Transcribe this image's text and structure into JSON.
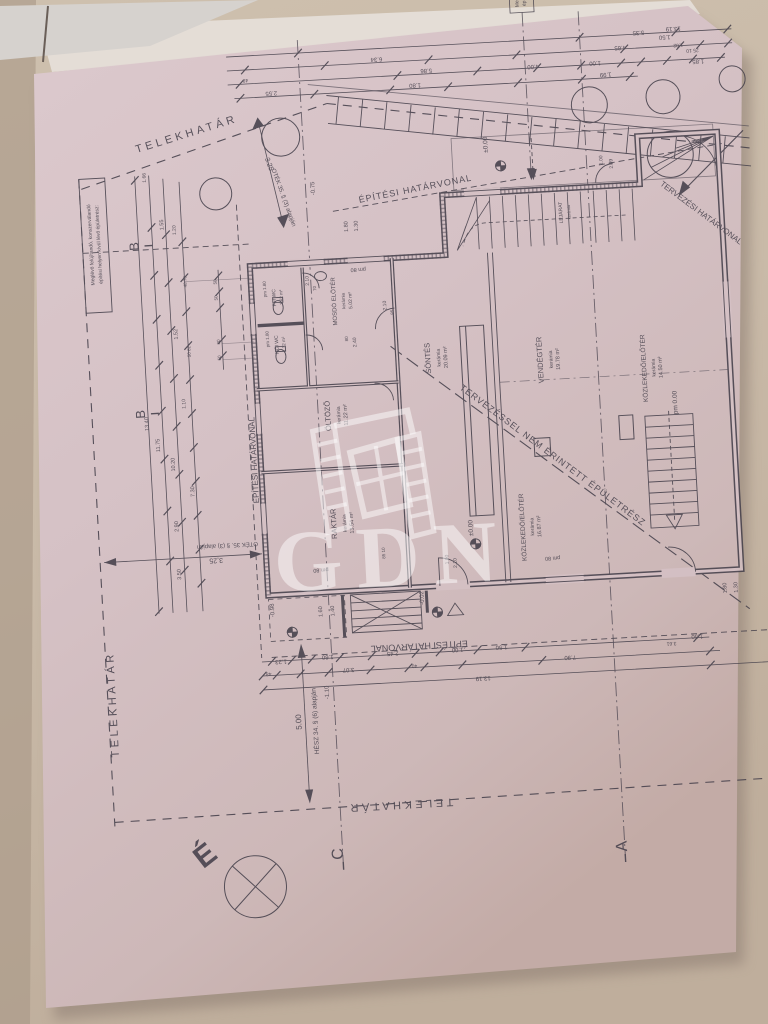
{
  "photo": {
    "background_wall": "#c9baa8",
    "paper_color": "#d6c2c6",
    "ink_color": "#45404b",
    "watermark_color": "rgba(255,255,255,0.5)"
  },
  "watermark": {
    "text": "GDN"
  },
  "compass": {
    "north_letter": "É"
  },
  "plan": {
    "labels": [
      {
        "t": "TELEKHATÁR",
        "x": 207,
        "y": 126,
        "r": -14,
        "s": 11,
        "ls": 3.5
      },
      {
        "t": "TELEKHATÁR",
        "x": 104,
        "y": 688,
        "r": -90,
        "s": 11,
        "ls": 3.5
      },
      {
        "t": "TELEKHATÁR",
        "x": 382,
        "y": 801,
        "r": 180,
        "s": 11,
        "ls": 3.5
      },
      {
        "t": "ÉPÍTÉSI HATÁRVONAL",
        "x": 432,
        "y": 193,
        "r": -8,
        "s": 9,
        "ls": 1
      },
      {
        "t": "ÉPÍTÉSI HATÁRVONAL",
        "x": 258,
        "y": 452,
        "r": -90,
        "s": 8
      },
      {
        "t": "ÉPÍTÉSI HATÁRVONAL",
        "x": 410,
        "y": 644,
        "r": 180,
        "s": 9
      },
      {
        "t": "TERVEZÉSI HATÁRVONAL",
        "x": 714,
        "y": 232,
        "r": 40,
        "s": 8
      },
      {
        "t": "TERVEZÉSSEL NEM ÉRINTETT ÉPÜLETRÉSZ",
        "x": 552,
        "y": 466,
        "r": 40,
        "s": 9,
        "ls": 1
      },
      {
        "t": "OTÉK 35. § (3) alapján",
        "x": 298,
        "y": 192,
        "r": 73,
        "s": 6
      },
      {
        "t": "3.25",
        "x": 285,
        "y": 158,
        "r": 73,
        "s": 7
      },
      {
        "t": "OTÉK 35. § (3) alapján",
        "x": 224,
        "y": 534,
        "r": 180,
        "s": 6
      },
      {
        "t": "3,25",
        "x": 212,
        "y": 548,
        "r": 180,
        "s": 7
      },
      {
        "t": "HÉSZ 34. § (6) alapján",
        "x": 304,
        "y": 716,
        "r": -90,
        "s": 6.5
      },
      {
        "t": "5.00",
        "x": 288,
        "y": 716,
        "r": -90,
        "s": 8
      },
      {
        "t": "Meglévő felújítandó, konszerválandó",
        "x": 106,
        "y": 228,
        "r": -90,
        "s": 5
      },
      {
        "t": "építési helyen kívül lévő épületrész:",
        "x": 114,
        "y": 228,
        "r": -90,
        "s": 5
      },
      {
        "t": "Me",
        "x": 545,
        "y": 11,
        "r": -90,
        "s": 5
      },
      {
        "t": "ép",
        "x": 552,
        "y": 11,
        "r": -90,
        "s": 5
      },
      {
        "t": "É",
        "x": 190,
        "y": 852,
        "r": -35,
        "s": 30,
        "w": 1
      },
      {
        "t": "C",
        "x": 322,
        "y": 850,
        "r": -90,
        "s": 16
      },
      {
        "t": "A",
        "x": 606,
        "y": 858,
        "r": -90,
        "s": 16
      },
      {
        "t": "B",
        "x": 152,
        "y": 232,
        "r": -90,
        "s": 13
      },
      {
        "t": "B",
        "x": 149,
        "y": 400,
        "r": -90,
        "s": 13
      },
      {
        "t": "SÖNTÉS",
        "x": 437,
        "y": 360,
        "r": -90,
        "s": 7.5
      },
      {
        "t": "kerámia",
        "x": 447,
        "y": 360,
        "r": -90,
        "s": 5
      },
      {
        "t": "20.09 m²",
        "x": 454,
        "y": 360,
        "r": -90,
        "s": 5.5
      },
      {
        "t": "VENDÉGTÉR",
        "x": 549,
        "y": 368,
        "r": -90,
        "s": 7.5
      },
      {
        "t": "kerámia",
        "x": 559,
        "y": 368,
        "r": -90,
        "s": 5
      },
      {
        "t": "19.78 m²",
        "x": 566,
        "y": 368,
        "r": -90,
        "s": 5.5
      },
      {
        "t": "KÖZLEKEDŐ/ELŐTÉR",
        "x": 652,
        "y": 382,
        "r": -90,
        "s": 6.5
      },
      {
        "t": "kerámia",
        "x": 661,
        "y": 382,
        "r": -90,
        "s": 5
      },
      {
        "t": "14.50 m²",
        "x": 668,
        "y": 382,
        "r": -90,
        "s": 5.5
      },
      {
        "t": "KÖZLEKEDŐ/ELŐTÉR",
        "x": 522,
        "y": 534,
        "r": -90,
        "s": 6.5
      },
      {
        "t": "kerámia",
        "x": 531,
        "y": 534,
        "r": -90,
        "s": 5
      },
      {
        "t": "16.87 m²",
        "x": 538,
        "y": 534,
        "r": -90,
        "s": 5.5
      },
      {
        "t": "ÖLTÖZŐ",
        "x": 334,
        "y": 412,
        "r": -90,
        "s": 7.5
      },
      {
        "t": "kerámia",
        "x": 344,
        "y": 412,
        "r": -90,
        "s": 5
      },
      {
        "t": "11.22 m²",
        "x": 351,
        "y": 412,
        "r": -90,
        "s": 5.5
      },
      {
        "t": "RAKTÁR",
        "x": 334,
        "y": 520,
        "r": -90,
        "s": 7.5
      },
      {
        "t": "kerámia",
        "x": 344,
        "y": 520,
        "r": -90,
        "s": 5
      },
      {
        "t": "13.54 m²",
        "x": 351,
        "y": 520,
        "r": -90,
        "s": 5.5
      },
      {
        "t": "MOSDÓ ELŐTÉR",
        "x": 346,
        "y": 298,
        "r": -90,
        "s": 6
      },
      {
        "t": "kerámia",
        "x": 355,
        "y": 298,
        "r": -90,
        "s": 4.5
      },
      {
        "t": "5.02 m²",
        "x": 362,
        "y": 298,
        "r": -90,
        "s": 5
      },
      {
        "t": "FFI WC",
        "x": 286,
        "y": 291,
        "r": -90,
        "s": 5
      },
      {
        "t": "1.62 m²",
        "x": 293,
        "y": 291,
        "r": -90,
        "s": 4.5
      },
      {
        "t": "pm 1.80",
        "x": 277,
        "y": 282,
        "r": -90,
        "s": 4.5
      },
      {
        "t": "NŐI WC",
        "x": 286,
        "y": 338,
        "r": -90,
        "s": 5
      },
      {
        "t": "1.32 m²",
        "x": 293,
        "y": 338,
        "r": -90,
        "s": 4.5
      },
      {
        "t": "pm 1.80",
        "x": 277,
        "y": 332,
        "r": -90,
        "s": 4.5
      },
      {
        "t": "LEJÁRAT",
        "x": 577,
        "y": 222,
        "r": -90,
        "s": 5
      },
      {
        "t": "kerámia",
        "x": 585,
        "y": 222,
        "r": -90,
        "s": 4
      },
      {
        "t": "±0.00",
        "x": 470,
        "y": 532,
        "r": -90,
        "s": 6.5
      },
      {
        "t": "±0.00",
        "x": 506,
        "y": 150,
        "r": -90,
        "s": 6.5
      },
      {
        "t": "pm 0.00",
        "x": 681,
        "y": 418,
        "r": -90,
        "s": 6.5
      },
      {
        "t": "-0.75",
        "x": 331,
        "y": 184,
        "r": -90,
        "s": 6
      },
      {
        "t": "-0.98",
        "x": 267,
        "y": 603,
        "r": -90,
        "s": 6
      },
      {
        "t": "-0.02",
        "x": 417,
        "y": 599,
        "r": -90,
        "s": 6
      },
      {
        "t": "-1.10",
        "x": 317,
        "y": 688,
        "r": -90,
        "s": 6
      },
      {
        "t": "pm 80",
        "x": 370,
        "y": 266,
        "r": 180,
        "s": 5.5
      },
      {
        "t": "pm 80",
        "x": 548,
        "y": 565,
        "r": 180,
        "s": 5.5
      },
      {
        "t": "pm 80",
        "x": 316,
        "y": 564,
        "r": 180,
        "s": 5.5
      },
      {
        "t": "13.19",
        "x": 698,
        "y": 43,
        "r": 180,
        "s": 6
      },
      {
        "t": "6.34",
        "x": 400,
        "y": 57,
        "r": 180,
        "s": 6
      },
      {
        "t": "5.86",
        "x": 449,
        "y": 71,
        "r": 180,
        "s": 6
      },
      {
        "t": "2.55",
        "x": 293,
        "y": 85,
        "r": 180,
        "s": 6
      },
      {
        "t": "1.80",
        "x": 437,
        "y": 85,
        "r": 180,
        "s": 6
      },
      {
        "t": "1.99",
        "x": 628,
        "y": 85,
        "r": 180,
        "s": 6
      },
      {
        "t": "48",
        "x": 268,
        "y": 71,
        "r": 180,
        "s": 5
      },
      {
        "t": "5.35",
        "x": 663,
        "y": 45,
        "r": 180,
        "s": 6
      },
      {
        "t": "4.65",
        "x": 644,
        "y": 59,
        "r": 180,
        "s": 6
      },
      {
        "t": "4.00",
        "x": 556,
        "y": 73,
        "r": 180,
        "s": 6
      },
      {
        "t": "1.00",
        "x": 618,
        "y": 73,
        "r": 180,
        "s": 6
      },
      {
        "t": "1.50",
        "x": 689,
        "y": 51,
        "r": 180,
        "s": 6
      },
      {
        "t": "1.85",
        "x": 721,
        "y": 77,
        "r": 180,
        "s": 6
      },
      {
        "t": "1.02",
        "x": 702,
        "y": 60,
        "r": 180,
        "s": 5
      },
      {
        "t": "25 10",
        "x": 716,
        "y": 66,
        "r": 180,
        "s": 5
      },
      {
        "t": "13.40",
        "x": 152,
        "y": 410,
        "r": -90,
        "s": 5.5
      },
      {
        "t": "11.75",
        "x": 162,
        "y": 432,
        "r": -90,
        "s": 5.5
      },
      {
        "t": "10.20",
        "x": 176,
        "y": 452,
        "r": -90,
        "s": 5.5
      },
      {
        "t": "2.90",
        "x": 176,
        "y": 514,
        "r": -90,
        "s": 5.5
      },
      {
        "t": "7.30",
        "x": 194,
        "y": 480,
        "r": -90,
        "s": 5.5
      },
      {
        "t": "3.50",
        "x": 176,
        "y": 562,
        "r": -90,
        "s": 5.5
      },
      {
        "t": "1.55",
        "x": 178,
        "y": 212,
        "r": -90,
        "s": 5.5
      },
      {
        "t": "1.20",
        "x": 190,
        "y": 218,
        "r": -90,
        "s": 5
      },
      {
        "t": "1.52",
        "x": 186,
        "y": 322,
        "r": -90,
        "s": 5.5
      },
      {
        "t": "1.10",
        "x": 190,
        "y": 392,
        "r": -90,
        "s": 5
      },
      {
        "t": "48 78",
        "x": 198,
        "y": 270,
        "r": -90,
        "s": 4.5
      },
      {
        "t": "50 82",
        "x": 198,
        "y": 340,
        "r": -90,
        "s": 4.5
      },
      {
        "t": "1.66",
        "x": 163,
        "y": 164,
        "r": -90,
        "s": 5
      },
      {
        "t": "50",
        "x": 228,
        "y": 272,
        "r": -90,
        "s": 4.5
      },
      {
        "t": "50",
        "x": 228,
        "y": 288,
        "r": -90,
        "s": 4.5
      },
      {
        "t": "80",
        "x": 228,
        "y": 332,
        "r": -90,
        "s": 4.5
      },
      {
        "t": "50",
        "x": 228,
        "y": 348,
        "r": -90,
        "s": 4.5
      },
      {
        "t": "2.10",
        "x": 320,
        "y": 276,
        "r": -90,
        "s": 5
      },
      {
        "t": "70",
        "x": 327,
        "y": 284,
        "r": -90,
        "s": 4.5
      },
      {
        "t": "2.10",
        "x": 396,
        "y": 305,
        "r": -90,
        "s": 5
      },
      {
        "t": "85",
        "x": 403,
        "y": 312,
        "r": -90,
        "s": 4.5
      },
      {
        "t": "80",
        "x": 356,
        "y": 336,
        "r": -90,
        "s": 4.5
      },
      {
        "t": "2.40",
        "x": 364,
        "y": 340,
        "r": -90,
        "s": 5
      },
      {
        "t": "85 10",
        "x": 381,
        "y": 552,
        "r": -90,
        "s": 4.5
      },
      {
        "t": "1.00",
        "x": 444,
        "y": 562,
        "r": -90,
        "s": 5
      },
      {
        "t": "2.10",
        "x": 452,
        "y": 566,
        "r": -90,
        "s": 5
      },
      {
        "t": "1.00",
        "x": 620,
        "y": 172,
        "r": -90,
        "s": 5
      },
      {
        "t": "2.49",
        "x": 630,
        "y": 176,
        "r": -90,
        "s": 5
      },
      {
        "t": "1.80",
        "x": 362,
        "y": 224,
        "r": -90,
        "s": 5.5
      },
      {
        "t": "1.30",
        "x": 372,
        "y": 224,
        "r": -90,
        "s": 5.5
      },
      {
        "t": "1.60",
        "x": 315,
        "y": 607,
        "r": -90,
        "s": 5.5
      },
      {
        "t": "1.40",
        "x": 327,
        "y": 607,
        "r": -90,
        "s": 5.5
      },
      {
        "t": "1.80",
        "x": 720,
        "y": 606,
        "r": -90,
        "s": 5.5
      },
      {
        "t": "1.30",
        "x": 731,
        "y": 606,
        "r": -90,
        "s": 5.5
      },
      {
        "t": "1.23",
        "x": 271,
        "y": 653,
        "r": 180,
        "s": 6
      },
      {
        "t": "48",
        "x": 258,
        "y": 665,
        "r": 180,
        "s": 5
      },
      {
        "t": "1.60",
        "x": 318,
        "y": 651,
        "r": 180,
        "s": 6
      },
      {
        "t": "3.07",
        "x": 338,
        "y": 665,
        "r": 180,
        "s": 6
      },
      {
        "t": "2.45",
        "x": 383,
        "y": 651,
        "r": 180,
        "s": 6
      },
      {
        "t": "40",
        "x": 404,
        "y": 665,
        "r": 180,
        "s": 5
      },
      {
        "t": "1.00",
        "x": 448,
        "y": 651,
        "r": 180,
        "s": 6
      },
      {
        "t": "1.50",
        "x": 492,
        "y": 651,
        "r": 180,
        "s": 6
      },
      {
        "t": "13.19",
        "x": 472,
        "y": 681,
        "r": 180,
        "s": 6
      },
      {
        "t": "7.90",
        "x": 560,
        "y": 665,
        "r": 180,
        "s": 6
      },
      {
        "t": "1.50",
        "x": 688,
        "y": 651,
        "r": 180,
        "s": 6
      },
      {
        "t": "3.61",
        "x": 662,
        "y": 657,
        "r": 180,
        "s": 5
      }
    ]
  }
}
